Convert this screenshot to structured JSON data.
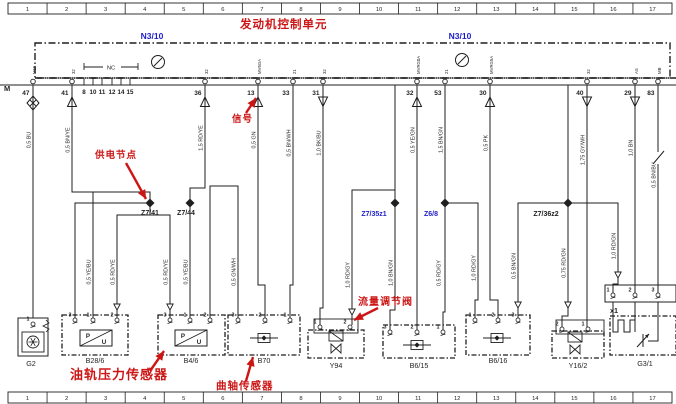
{
  "colors": {
    "red": "#cc1616",
    "blue": "#1d1dc8",
    "ink": "#1f1f1f"
  },
  "ruler_top": [
    "1",
    "2",
    "3",
    "4",
    "5",
    "6",
    "7",
    "8",
    "9",
    "10",
    "11",
    "12",
    "13",
    "14",
    "15",
    "16",
    "17"
  ],
  "ruler_bottom": [
    "1",
    "2",
    "3",
    "4",
    "5",
    "6",
    "7",
    "8",
    "9",
    "10",
    "11",
    "12",
    "13",
    "14",
    "15",
    "16",
    "17"
  ],
  "ecu": {
    "name_cn": "发动机控制单元",
    "code_left": "N3/10",
    "code_right": "N3/10",
    "bus_label": "M",
    "nc": {
      "label": "NC",
      "x1": 84,
      "x2": 138,
      "y": 67
    },
    "circle_symbols": [
      [
        158,
        62
      ],
      [
        462,
        60
      ]
    ]
  },
  "pins": [
    {
      "num": "47",
      "x": 33,
      "arrow": "gnd",
      "tag": "M15"
    },
    {
      "num": "41",
      "x": 72,
      "arrow": "up",
      "tag": "32"
    },
    {
      "num": "36",
      "x": 205,
      "arrow": "up",
      "tag": "32"
    },
    {
      "num": "13",
      "x": 258,
      "arrow": "up",
      "tag": "MV6GA"
    },
    {
      "num": "33",
      "x": 293,
      "arrow": "none",
      "tag": "21"
    },
    {
      "num": "31",
      "x": 323,
      "arrow": "down",
      "tag": "32"
    },
    {
      "num": "32",
      "x": 417,
      "arrow": "up",
      "tag": "MVRG0A"
    },
    {
      "num": "53",
      "x": 445,
      "arrow": "none",
      "tag": "21"
    },
    {
      "num": "30",
      "x": 490,
      "arrow": "up",
      "tag": "MVRG5A"
    },
    {
      "num": "40",
      "x": 587,
      "arrow": "down",
      "tag": "32"
    },
    {
      "num": "29",
      "x": 635,
      "arrow": "down",
      "tag": "AS"
    },
    {
      "num": "83",
      "x": 658,
      "arrow": "none",
      "tag": "MB"
    }
  ],
  "group_pins": {
    "labels": [
      "8",
      "10",
      "11",
      "12",
      "14",
      "15"
    ],
    "xs": [
      84,
      93,
      102,
      112,
      121,
      130
    ]
  },
  "wires": [
    {
      "pts": [
        [
          33,
          85
        ],
        [
          33,
          318
        ]
      ],
      "label": "0,5 BU",
      "lx": 33,
      "ly": 140
    },
    {
      "pts": [
        [
          72,
          85
        ],
        [
          72,
          192
        ],
        [
          150,
          192
        ],
        [
          150,
          203
        ]
      ],
      "label": "0,5 BN/YE",
      "lx": 72,
      "ly": 140
    },
    {
      "pts": [
        [
          205,
          85
        ],
        [
          205,
          188
        ],
        [
          190,
          188
        ],
        [
          190,
          203
        ]
      ],
      "label": "1,5 RD/YE",
      "lx": 205,
      "ly": 138
    },
    {
      "pts": [
        [
          150,
          203
        ],
        [
          75,
          203
        ],
        [
          75,
          318
        ]
      ]
    },
    {
      "pts": [
        [
          150,
          203
        ],
        [
          150,
          215
        ],
        [
          117,
          215
        ],
        [
          117,
          318
        ]
      ],
      "label": "0,5 RD/YE",
      "lx": 117,
      "ly": 272,
      "arrows": [
        [
          117,
          310
        ]
      ]
    },
    {
      "pts": [
        [
          150,
          215
        ],
        [
          170,
          215
        ],
        [
          170,
          318
        ]
      ],
      "label": "0,5 RD/YE",
      "lx": 170,
      "ly": 272,
      "arrows": [
        [
          170,
          310
        ]
      ]
    },
    {
      "pts": [
        [
          190,
          203
        ],
        [
          190,
          318
        ]
      ],
      "label": "0,5 YE/BU",
      "lx": 190,
      "ly": 272
    },
    {
      "pts": [
        [
          93,
          318
        ],
        [
          93,
          192
        ]
      ],
      "label": "0,5 YE/BU",
      "lx": 93,
      "ly": 272
    },
    {
      "pts": [
        [
          258,
          85
        ],
        [
          258,
          285
        ],
        [
          265,
          285
        ],
        [
          265,
          318
        ]
      ],
      "label": "0,5 GN",
      "lx": 258,
      "ly": 140
    },
    {
      "pts": [
        [
          293,
          85
        ],
        [
          293,
          285
        ],
        [
          290,
          285
        ],
        [
          290,
          318
        ]
      ],
      "label": "0,5 BN/WH",
      "lx": 293,
      "ly": 143
    },
    {
      "pts": [
        [
          210,
          318
        ],
        [
          210,
          186
        ],
        [
          238,
          186
        ],
        [
          238,
          318
        ]
      ],
      "label": "0,5 GN/WH",
      "lx": 238,
      "ly": 272
    },
    {
      "pts": [
        [
          323,
          85
        ],
        [
          323,
          308
        ],
        [
          320,
          308
        ],
        [
          320,
          325
        ]
      ],
      "label": "1,0 BK/BU",
      "lx": 323,
      "ly": 143
    },
    {
      "pts": [
        [
          395,
          85
        ],
        [
          395,
          203
        ]
      ]
    },
    {
      "pts": [
        [
          395,
          203
        ],
        [
          395,
          190
        ],
        [
          352,
          190
        ],
        [
          352,
          325
        ]
      ],
      "label": "1,0 RD/GY",
      "lx": 352,
      "ly": 275,
      "arrows": [
        [
          352,
          315
        ]
      ]
    },
    {
      "pts": [
        [
          395,
          203
        ],
        [
          395,
          310
        ],
        [
          390,
          310
        ],
        [
          390,
          330
        ]
      ],
      "label": "1,0 BN/GN",
      "lx": 395,
      "ly": 273
    },
    {
      "pts": [
        [
          417,
          85
        ],
        [
          417,
          330
        ]
      ],
      "label": "0,5 YE/GN",
      "lx": 417,
      "ly": 140
    },
    {
      "pts": [
        [
          445,
          85
        ],
        [
          445,
          203
        ]
      ],
      "label": "1,5 BN/GN",
      "lx": 445,
      "ly": 140
    },
    {
      "pts": [
        [
          445,
          203
        ],
        [
          445,
          312
        ],
        [
          443,
          312
        ],
        [
          443,
          330
        ]
      ],
      "label": "0,5 RD/GY",
      "lx": 443,
      "ly": 273
    },
    {
      "pts": [
        [
          445,
          203
        ],
        [
          478,
          203
        ],
        [
          478,
          300
        ],
        [
          475,
          300
        ],
        [
          475,
          318
        ]
      ],
      "label": "1,0 RD/GY",
      "lx": 478,
      "ly": 268
    },
    {
      "pts": [
        [
          490,
          85
        ],
        [
          490,
          300
        ],
        [
          498,
          300
        ],
        [
          498,
          318
        ]
      ],
      "label": "0,5 PK",
      "lx": 490,
      "ly": 143
    },
    {
      "pts": [
        [
          568,
          85
        ],
        [
          568,
          203
        ]
      ]
    },
    {
      "pts": [
        [
          568,
          203
        ],
        [
          518,
          203
        ],
        [
          518,
          318
        ]
      ],
      "label": "0,5 BN/GN",
      "lx": 518,
      "ly": 266,
      "arrows": [
        [
          518,
          308
        ]
      ]
    },
    {
      "pts": [
        [
          568,
          203
        ],
        [
          568,
          316
        ],
        [
          562,
          316
        ],
        [
          562,
          327
        ]
      ],
      "label": "0,75 RD/GN",
      "lx": 568,
      "ly": 263,
      "arrows": [
        [
          568,
          308
        ]
      ]
    },
    {
      "pts": [
        [
          568,
          203
        ],
        [
          618,
          203
        ],
        [
          618,
          284
        ],
        [
          613,
          284
        ],
        [
          613,
          293
        ]
      ],
      "label": "1,0 RD/GN",
      "lx": 618,
      "ly": 246,
      "arrows": [
        [
          618,
          278
        ]
      ]
    },
    {
      "pts": [
        [
          587,
          85
        ],
        [
          587,
          327
        ]
      ],
      "label": "1,75 GY/WH",
      "lx": 587,
      "ly": 150
    },
    {
      "pts": [
        [
          635,
          85
        ],
        [
          635,
          293
        ]
      ],
      "label": "1,0 BN",
      "lx": 635,
      "ly": 148
    },
    {
      "pts": [
        [
          658,
          85
        ],
        [
          658,
          293
        ]
      ],
      "label": "0,5 BN/BU",
      "lx": 658,
      "ly": 175,
      "break": [
        658,
        158
      ]
    }
  ],
  "nodes": [
    {
      "label": "Z7/41",
      "x": 150,
      "y": 203,
      "color": "ink",
      "tx": 150,
      "ty": 215
    },
    {
      "label": "Z7/44",
      "x": 190,
      "y": 203,
      "color": "ink",
      "tx": 186,
      "ty": 215
    },
    {
      "label": "Z7/35z1",
      "x": 395,
      "y": 203,
      "color": "blue",
      "tx": 374,
      "ty": 216
    },
    {
      "label": "Z6/8",
      "x": 445,
      "y": 203,
      "color": "blue",
      "tx": 431,
      "ty": 216
    },
    {
      "label": "Z7/36z2",
      "x": 568,
      "y": 203,
      "color": "ink",
      "tx": 546,
      "ty": 216
    }
  ],
  "components": [
    {
      "id": "G2",
      "label": "G2",
      "type": "generator",
      "box": [
        18,
        318,
        30,
        38
      ],
      "pin_y": 322,
      "pins": [
        {
          "n": "1",
          "x": 33
        }
      ],
      "sym": [
        33,
        342
      ],
      "label_xy": [
        31,
        366
      ]
    },
    {
      "id": "B28/6",
      "label": "B28/6",
      "type": "pressure",
      "box": [
        62,
        315,
        66,
        40
      ],
      "pin_y": 318,
      "pins": [
        {
          "n": "3",
          "x": 75
        },
        {
          "n": "1",
          "x": 93
        },
        {
          "n": "2",
          "x": 117
        }
      ],
      "sym": [
        80,
        330
      ],
      "label_xy": [
        95,
        363
      ]
    },
    {
      "id": "B4/6",
      "label": "B4/6",
      "type": "pressure",
      "box": [
        158,
        315,
        67,
        40
      ],
      "pin_y": 318,
      "pins": [
        {
          "n": "3",
          "x": 170
        },
        {
          "n": "1",
          "x": 190
        },
        {
          "n": "2",
          "x": 210
        }
      ],
      "sym": [
        175,
        330
      ],
      "label_xy": [
        191,
        363
      ]
    },
    {
      "id": "B70",
      "label": "B70",
      "type": "inductive",
      "box": [
        228,
        315,
        72,
        40
      ],
      "pin_y": 318,
      "pins": [
        {
          "n": "3",
          "x": 238
        },
        {
          "n": "2",
          "x": 265
        },
        {
          "n": "1",
          "x": 290
        }
      ],
      "sym": [
        264,
        338
      ],
      "label_xy": [
        264,
        363
      ]
    },
    {
      "id": "Y94",
      "label": "Y94",
      "type": "valve",
      "box": [
        308,
        330,
        56,
        28
      ],
      "solid": [
        314,
        319,
        44,
        14
      ],
      "pin_y": 325,
      "pins": [
        {
          "n": "1",
          "x": 320
        },
        {
          "n": "2",
          "x": 350
        }
      ],
      "sym": [
        336,
        336
      ],
      "label_xy": [
        336,
        368
      ]
    },
    {
      "id": "B6/15",
      "label": "B6/15",
      "type": "inductive",
      "box": [
        383,
        325,
        72,
        33
      ],
      "pin_y": 330,
      "pins": [
        {
          "n": "3",
          "x": 390
        },
        {
          "n": "2",
          "x": 417
        },
        {
          "n": "1",
          "x": 443
        }
      ],
      "sym": [
        417,
        345
      ],
      "label_xy": [
        419,
        368
      ]
    },
    {
      "id": "B6/16",
      "label": "B6/16",
      "type": "inductive",
      "box": [
        466,
        315,
        64,
        40
      ],
      "pin_y": 318,
      "pins": [
        {
          "n": "1",
          "x": 475
        },
        {
          "n": "2",
          "x": 498
        },
        {
          "n": "3",
          "x": 518
        }
      ],
      "sym": [
        497,
        338
      ],
      "label_xy": [
        498,
        363
      ]
    },
    {
      "id": "Y16/2",
      "label": "Y16/2",
      "type": "valve",
      "box": [
        552,
        331,
        52,
        27
      ],
      "solid": [
        556,
        320,
        48,
        14
      ],
      "pin_y": 327,
      "pins": [
        {
          "n": "2",
          "x": 562
        },
        {
          "n": "1",
          "x": 588
        }
      ],
      "sym": [
        575,
        337
      ],
      "label_xy": [
        578,
        368
      ]
    },
    {
      "id": "x1",
      "label": "x1",
      "type": "connector",
      "box": [
        605,
        285,
        71,
        17
      ],
      "pin_y": 293,
      "pins": [
        {
          "n": "1",
          "x": 613
        },
        {
          "n": "2",
          "x": 635
        },
        {
          "n": "3",
          "x": 658
        }
      ],
      "label_xy": [
        610,
        313
      ]
    },
    {
      "id": "G3/1",
      "label": "G3/1",
      "type": "lambda",
      "box": [
        610,
        316,
        66,
        39
      ],
      "label_xy": [
        645,
        366
      ]
    }
  ],
  "annotations": [
    {
      "text": "发动机控制单元",
      "x": 240,
      "y": 28,
      "size": 11.5
    },
    {
      "text": "供电节点",
      "x": 95,
      "y": 158,
      "size": 9.5,
      "arrow": [
        126,
        163,
        146,
        199
      ]
    },
    {
      "text": "信号",
      "x": 232,
      "y": 122,
      "size": 9.5,
      "arrow": [
        246,
        113,
        256,
        98
      ]
    },
    {
      "text": "流量调节阀",
      "x": 358,
      "y": 305,
      "size": 10,
      "arrow": [
        378,
        308,
        354,
        320
      ]
    },
    {
      "text": "油轨压力传感器",
      "x": 70,
      "y": 379,
      "size": 13,
      "arrow": [
        150,
        371,
        164,
        351
      ]
    },
    {
      "text": "曲轴传感器",
      "x": 216,
      "y": 389,
      "size": 10.5,
      "arrow": [
        246,
        381,
        253,
        357
      ]
    }
  ]
}
